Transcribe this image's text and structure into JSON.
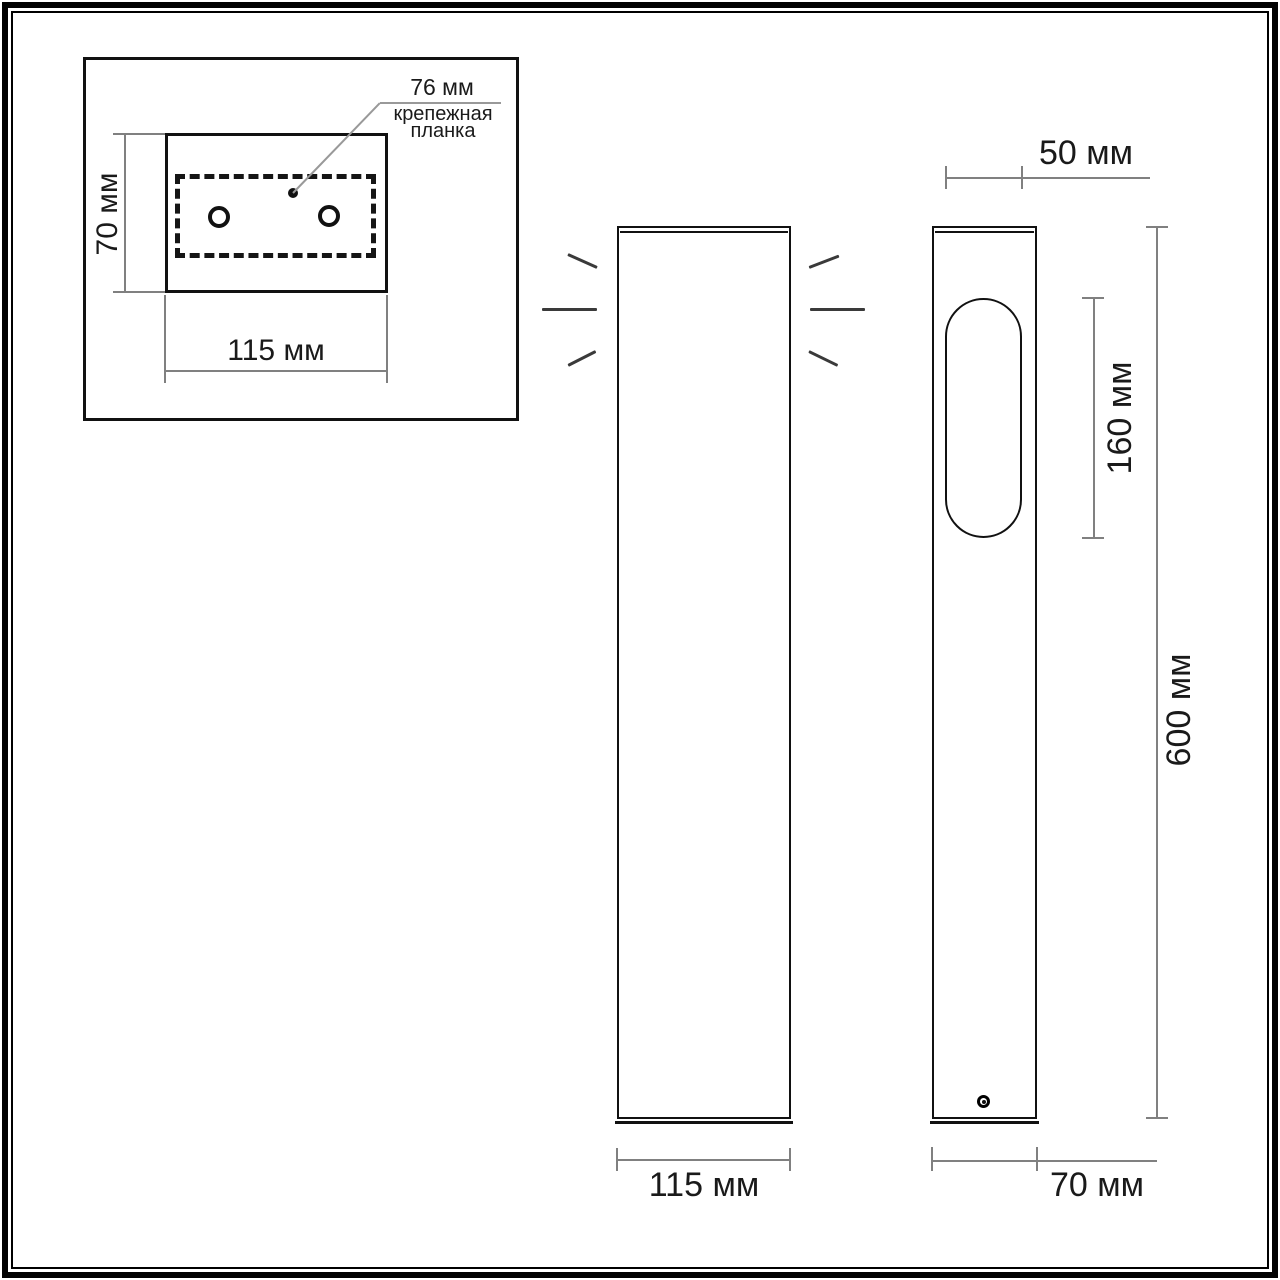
{
  "drawing": {
    "inset": {
      "bracket_width_label": "76 мм",
      "bracket_name_line1": "крепежная",
      "bracket_name_line2": "планка",
      "plate_height_label": "70 мм",
      "plate_width_label": "115 мм"
    },
    "front_view": {
      "body_width_label": "115 мм"
    },
    "side_view": {
      "top_width_label": "50 мм",
      "window_height_label": "160 мм",
      "total_height_label": "600 мм",
      "body_depth_label": "70 мм"
    }
  },
  "colors": {
    "outline": "#111111",
    "dimension_line": "#808080",
    "leader_line": "#999999",
    "text": "#1a1a1a",
    "background": "#ffffff"
  }
}
